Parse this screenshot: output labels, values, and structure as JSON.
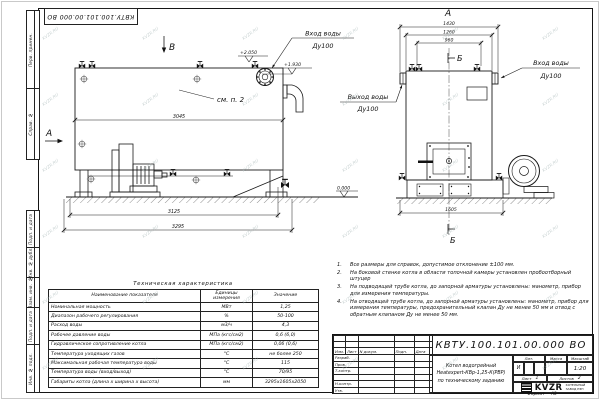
{
  "watermark": {
    "text": "KVZR.RU"
  },
  "stamp_top": {
    "text": "КВТУ.100.101.00.000 ВО"
  },
  "strip": {
    "top": [
      {
        "label": "Перв. примен."
      },
      {
        "label": "Справ. №"
      }
    ],
    "bottom": [
      {
        "label": "Подп. и дата"
      },
      {
        "label": "Инв. № дубл."
      },
      {
        "label": "Взам. инв. №"
      },
      {
        "label": "Подп. и дата"
      },
      {
        "label": "Инв. № подл."
      }
    ]
  },
  "side_view": {
    "view_dir_top": "В",
    "view_dir_left": "А",
    "see_note": "см. п. 2",
    "elev_top": "+2.050",
    "elev_inlet": "+1.930",
    "elev_ground": "0.000",
    "inlet_label": "Вход воды",
    "inlet_dn": "Ду100",
    "dim_body": "3045",
    "dim_frame": "3125",
    "dim_overall": "3295"
  },
  "front_view": {
    "view_label": "А",
    "section_top": "Б",
    "section_bottom": "Б",
    "dim_overall_top": "1430",
    "dim_body": "1260",
    "dim_valves": "960",
    "dim_base": "1605",
    "outlet_label": "Выход воды",
    "outlet_dn": "Ду100",
    "inlet_label": "Вход воды",
    "inlet_dn": "Ду100"
  },
  "tech_table": {
    "title": "Техническая характеристика",
    "headers": [
      "Наименование показателя",
      "Единицы измерения",
      "Значение"
    ],
    "rows": [
      [
        "Номинальная мощность",
        "МВт",
        "1,25"
      ],
      [
        "Диапазон рабочего регулирования",
        "%",
        "50-100"
      ],
      [
        "Расход воды",
        "м3/ч",
        "4,3"
      ],
      [
        "Рабочее давление воды",
        "МПа (кгс/см2)",
        "0,6 (6,0)"
      ],
      [
        "Гидравлическое сопротивление котла",
        "МПа (кгс/см2)",
        "0,06 (0,6)"
      ],
      [
        "Температура уходящих газов",
        "°С",
        "не более 250"
      ],
      [
        "Максимальная рабочая температура воды",
        "°С",
        "115"
      ],
      [
        "Температура воды (вход/выход)",
        "°С",
        "70/95"
      ],
      [
        "Габариты котла (длина х ширина х высота)",
        "мм",
        "3295х1605х2050"
      ]
    ]
  },
  "notes": {
    "items": [
      {
        "n": "1.",
        "text": "Все размеры для справок, допустимое отклонение ±100 мм."
      },
      {
        "n": "2.",
        "text": "На боковой стенке котла в области топочной камеры установлен пробоотборный штуцер"
      },
      {
        "n": "3.",
        "text": "На подводящей трубе котла, до запорной арматуры установлены: манометр, прибор для измерения температуры."
      },
      {
        "n": "4.",
        "text": "На отводящей трубе котла, до запорной арматуры установлены: манометр, прибор для измерения температуры, предохранительный клапан Ду не менее 50 мм и отвод с обратным клапаном Ду не менее 50 мм."
      }
    ]
  },
  "title_block": {
    "doc_number": "КВТУ.100.101.00.000 ВО",
    "rev_cols": [
      "Изм.",
      "Лист",
      "N докум.",
      "Подп.",
      "Дата"
    ],
    "staff": [
      "Разраб.",
      "Пров.",
      "Т.контр.",
      "Н.контр.",
      "Утв."
    ],
    "product": [
      "Котел водогрейный",
      "Heatexpert-КВр-1,25-К(РВР)",
      "по техническому заданию"
    ],
    "lit_label": "Лит.",
    "lit_value": "И",
    "mass_label": "Масса",
    "scale_label": "Масштаб",
    "scale_value": "1:20",
    "sheet_label": "Лист",
    "sheet_value": "1",
    "sheets_label": "Листов",
    "sheets_value": "2",
    "logo_text": "KVZR",
    "logo_sub1": "КОТЕЛЬНЫЙ",
    "logo_sub2": "ЗАВОД РЭП",
    "format_label": "Формат",
    "format_value": "А3"
  }
}
